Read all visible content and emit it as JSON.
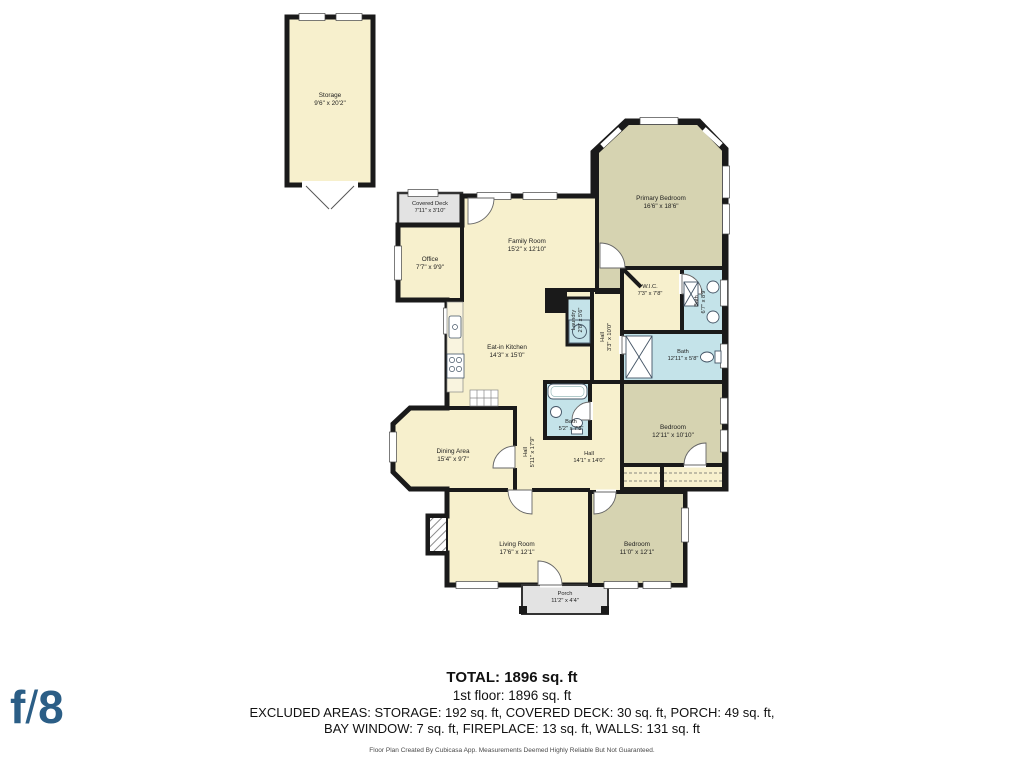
{
  "plan": {
    "rooms": {
      "storage": {
        "name": "Storage",
        "dims": "9'6\" x 20'2\""
      },
      "covered_deck": {
        "name": "Covered Deck",
        "dims": "7'11\" x 3'10\""
      },
      "office": {
        "name": "Office",
        "dims": "7'7\" x 9'9\""
      },
      "family_room": {
        "name": "Family Room",
        "dims": "15'2\" x 12'10\""
      },
      "primary_bedroom": {
        "name": "Primary Bedroom",
        "dims": "16'6\" x 18'6\""
      },
      "wic": {
        "name": "W.I.C.",
        "dims": "7'3\" x 7'8\""
      },
      "bath_primary": {
        "name": "Bath",
        "dims": "6'7\" x 8'9\""
      },
      "bath_hall": {
        "name": "Bath",
        "dims": "12'11\" x 5'8\""
      },
      "laundry": {
        "name": "Laundry",
        "dims": "2'8\" x 5'6\""
      },
      "hall_upper": {
        "name": "Hall",
        "dims": "3'3\" x 10'0\""
      },
      "kitchen": {
        "name": "Eat-in Kitchen",
        "dims": "14'3\" x 15'0\""
      },
      "bath_center": {
        "name": "Bath",
        "dims": "5'2\" x 7'8\""
      },
      "bedroom_mid": {
        "name": "Bedroom",
        "dims": "12'11\" x 10'10\""
      },
      "dining": {
        "name": "Dining Area",
        "dims": "15'4\" x 9'7\""
      },
      "hall_mid": {
        "name": "Hall",
        "dims": "5'11\" x 17'9\""
      },
      "hall_lower": {
        "name": "Hall",
        "dims": "14'1\" x 14'0\""
      },
      "living_room": {
        "name": "Living Room",
        "dims": "17'6\" x 12'1\""
      },
      "bedroom_lower": {
        "name": "Bedroom",
        "dims": "11'0\" x 12'1\""
      },
      "porch": {
        "name": "Porch",
        "dims": "11'2\" x 4'4\""
      }
    },
    "summary": {
      "total": "TOTAL: 1896 sq. ft",
      "floor": "1st floor: 1896 sq. ft",
      "excluded_line1": "EXCLUDED AREAS: STORAGE: 192 sq. ft, COVERED DECK: 30 sq. ft, PORCH: 49 sq. ft,",
      "excluded_line2": "BAY WINDOW: 7 sq. ft, FIREPLACE: 13 sq. ft, WALLS: 131 sq. ft"
    },
    "disclaimer": "Floor Plan Created By Cubicasa App. Measurements Deemed Highly Reliable But Not Guaranteed.",
    "logo": {
      "text_f": "f",
      "text_slash": "/",
      "text_8": "8"
    },
    "colors": {
      "room": "#f7f0cd",
      "bedroom": "#d6d3b1",
      "bath": "#c4e3e9",
      "excluded": "#e3e3e3",
      "wall": "#1a1a1a",
      "logo": "#2b5e86"
    }
  }
}
